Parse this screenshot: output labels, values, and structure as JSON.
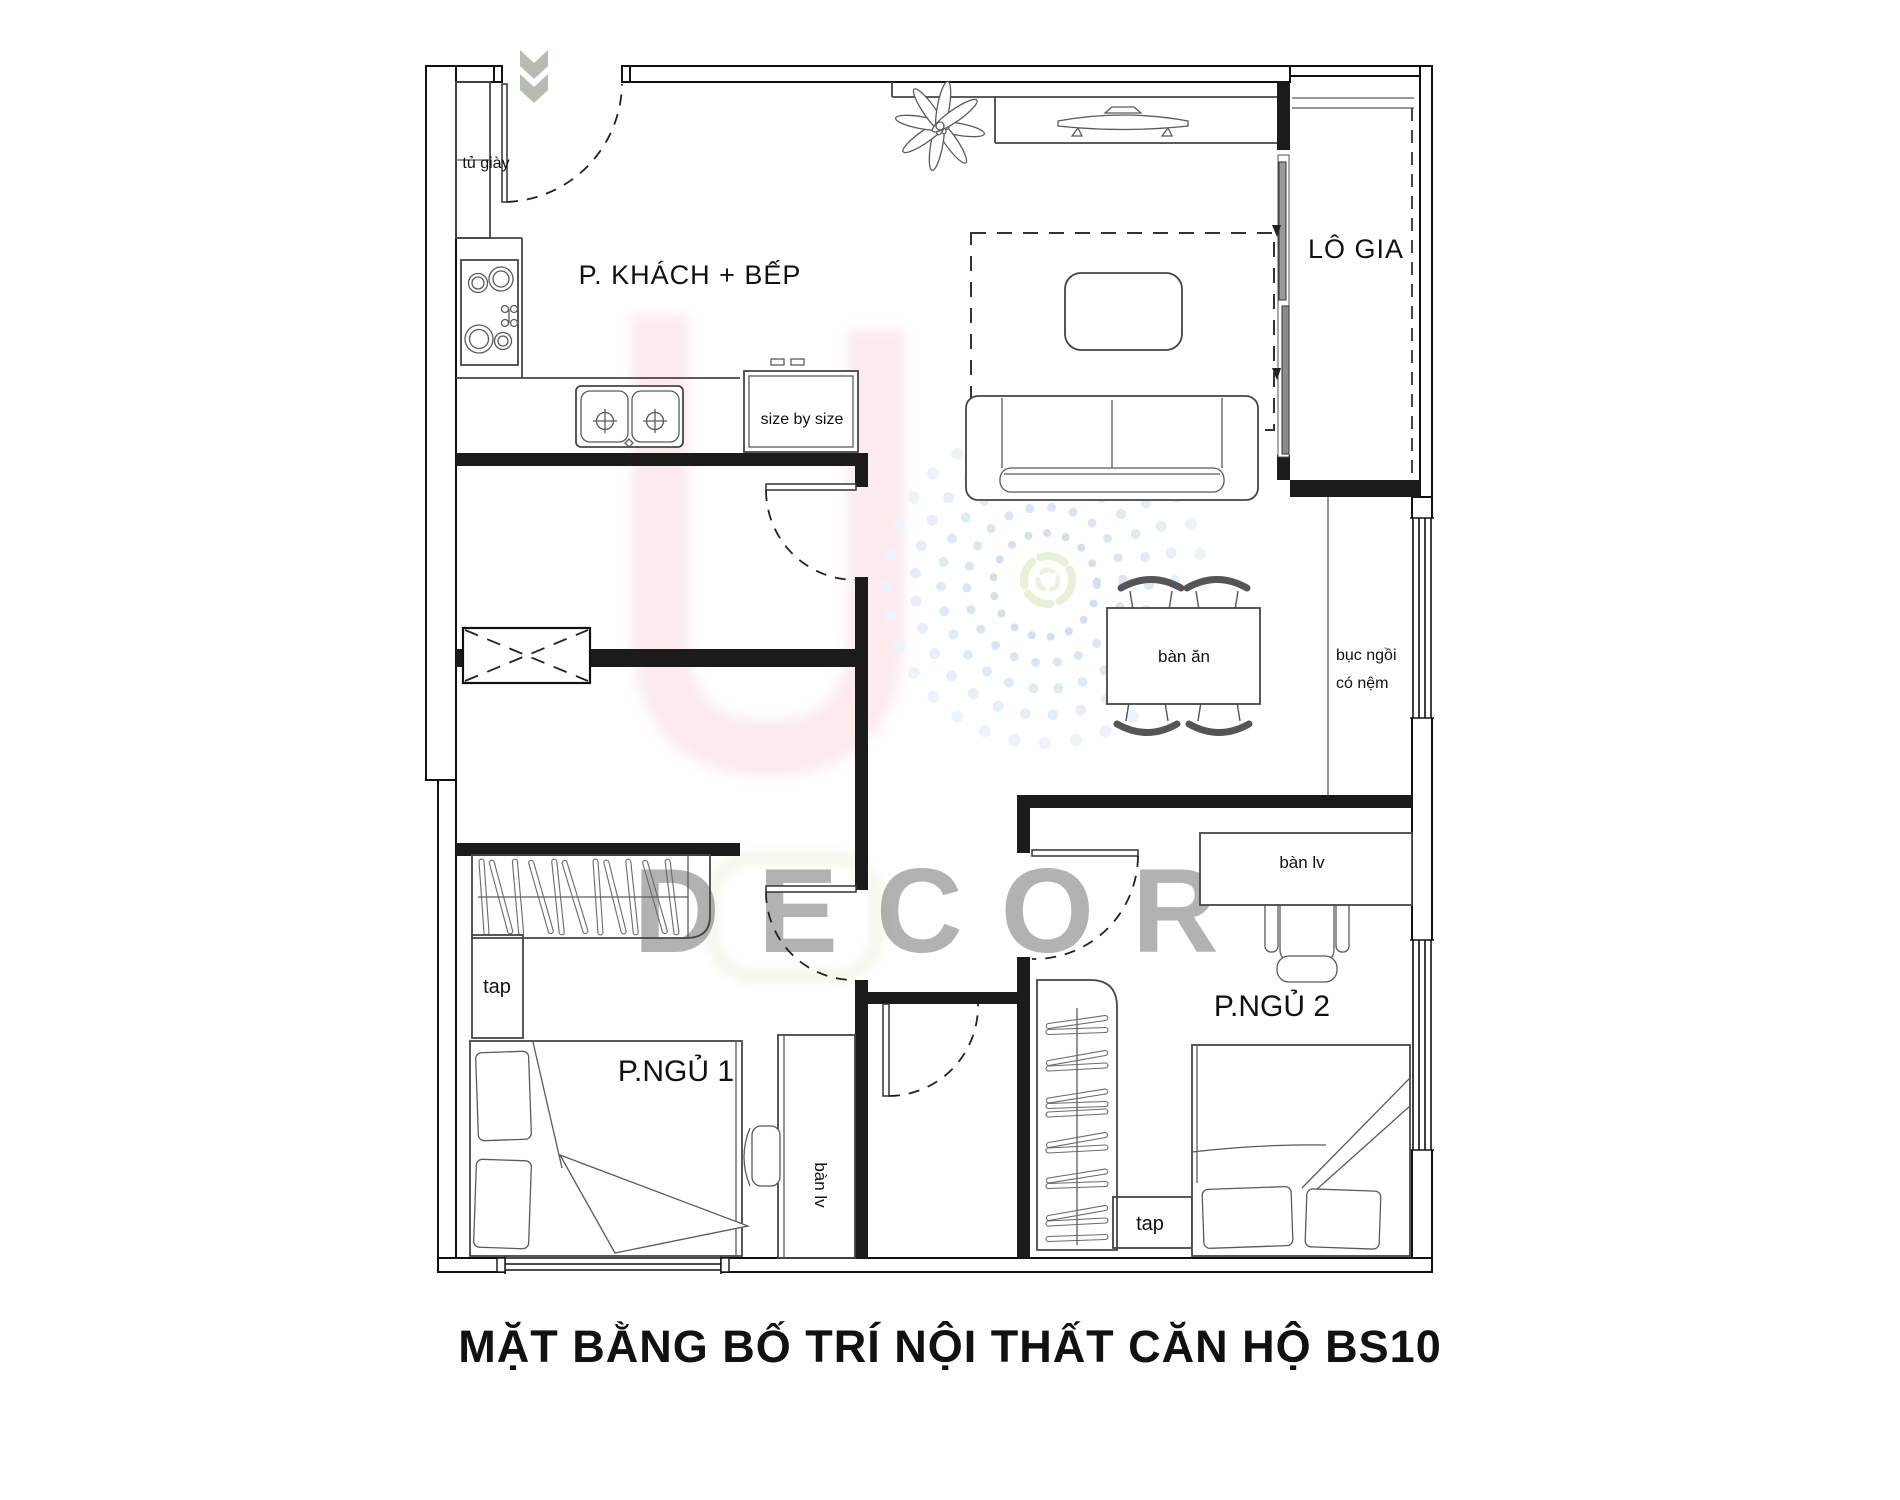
{
  "title": "MẶT BẰNG BỐ TRÍ NỘI THẤT CĂN HỘ BS10",
  "watermark": {
    "text": "DECOR"
  },
  "rooms": {
    "living_kitchen": "P. KHÁCH + BẾP",
    "loggia": "LÔ GIA",
    "bedroom1": "P.NGỦ 1",
    "bedroom2": "P.NGỦ 2"
  },
  "labels": {
    "shoe_cabinet": "tủ giày",
    "fridge": "size by size",
    "dining_table": "bàn ăn",
    "bench_line1": "bục ngồi",
    "bench_line2": "có nệm",
    "desk_bedroom2": "bàn lv",
    "desk_bedroom1": "bàn lv",
    "cabinet_bedroom1": "tap",
    "cabinet_bedroom2": "tap"
  },
  "colors": {
    "wall": "#1b1b1b",
    "furniture_line": "#454545",
    "paper": "#ffffff",
    "entry_arrow": "#b7bcb2",
    "watermark_pink": "#f7cdd6",
    "watermark_teal": "#cfe9e2",
    "watermark_blue": "#c9dcee"
  }
}
